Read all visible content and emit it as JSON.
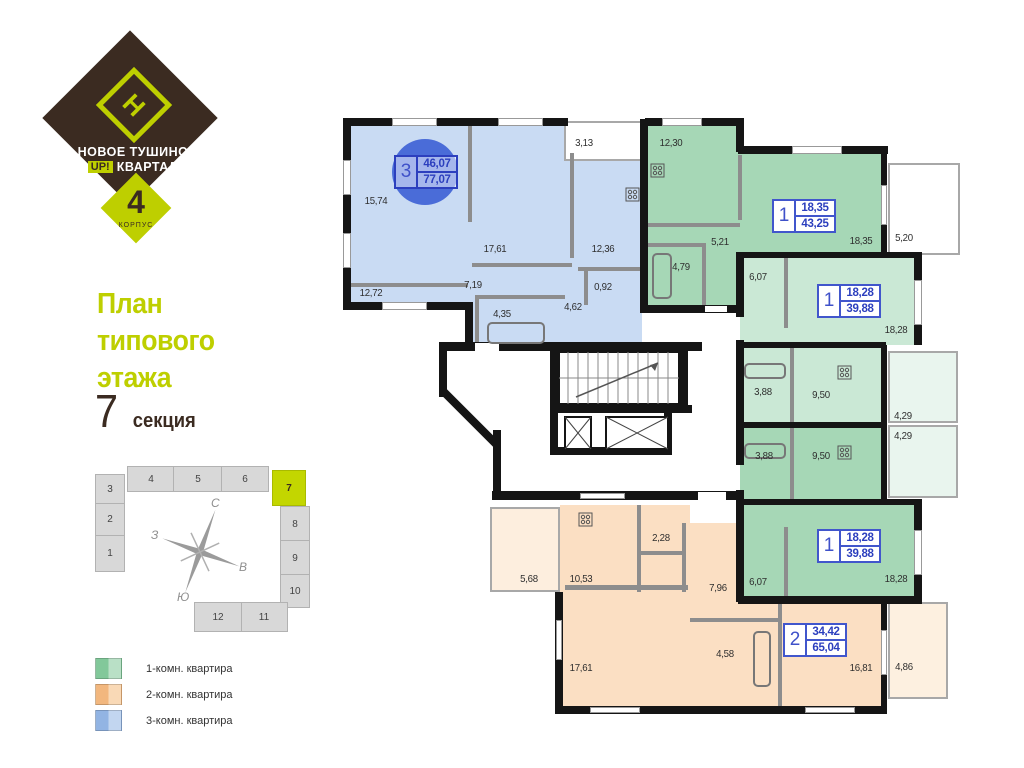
{
  "logo": {
    "mark": "Н",
    "name_line1": "НОВОЕ ТУШИНО",
    "up_badge": "UP!",
    "name_line2": "КВАРТАЛ",
    "building_number": "4",
    "building_caption": "КОРПУС"
  },
  "title": {
    "line1": "План",
    "line2": "типового",
    "line3": "этажа",
    "section_number": "7",
    "section_word": "секция"
  },
  "sitemap": {
    "highlighted_section": "7",
    "sections": [
      "1",
      "2",
      "3",
      "4",
      "5",
      "6",
      "7",
      "8",
      "9",
      "10",
      "11",
      "12"
    ],
    "compass": {
      "north": "С",
      "south": "Ю",
      "west": "З",
      "east": "В"
    }
  },
  "legend": {
    "items": [
      {
        "label": "1-комн. квартира",
        "color": "#a6d7b6"
      },
      {
        "label": "2-комн. квартира",
        "color": "#fbdfc3"
      },
      {
        "label": "3-комн. квартира",
        "color": "#c9dbf3"
      }
    ]
  },
  "plan": {
    "apartments": [
      {
        "type": "3room",
        "rooms_count": "3",
        "living_area": "46,07",
        "total_area": "77,07",
        "fill": "#c9dbf3"
      },
      {
        "type": "1room-a",
        "rooms_count": "1",
        "living_area": "18,35",
        "total_area": "43,25",
        "fill": "#a6d7b6"
      },
      {
        "type": "1room-b",
        "rooms_count": "1",
        "living_area": "18,28",
        "total_area": "39,88",
        "fill": "#cae8d5"
      },
      {
        "type": "1room-c",
        "rooms_count": "1",
        "living_area": "18,28",
        "total_area": "39,88",
        "fill": "#a6d7b6"
      },
      {
        "type": "2room",
        "rooms_count": "2",
        "living_area": "34,42",
        "total_area": "65,04",
        "fill": "#fbdfc3"
      }
    ],
    "room_areas": [
      "15,74",
      "12,72",
      "17,61",
      "7,19",
      "12,36",
      "0,92",
      "4,62",
      "4,35",
      "3,13",
      "12,30",
      "5,21",
      "4,79",
      "18,35",
      "5,20",
      "6,07",
      "18,28",
      "3,88",
      "9,50",
      "4,29",
      "4,29",
      "3,88",
      "9,50",
      "6,07",
      "18,28",
      "5,68",
      "10,53",
      "2,28",
      "7,96",
      "17,61",
      "4,58",
      "16,81",
      "4,86"
    ],
    "colors": {
      "wall": "#151515",
      "partition": "#8d8d8d",
      "label_blue": "#3f51c9",
      "circle_blue": "#4a6cd8",
      "accent_lime": "#becf00",
      "brand_brown": "#3b2b21"
    }
  }
}
